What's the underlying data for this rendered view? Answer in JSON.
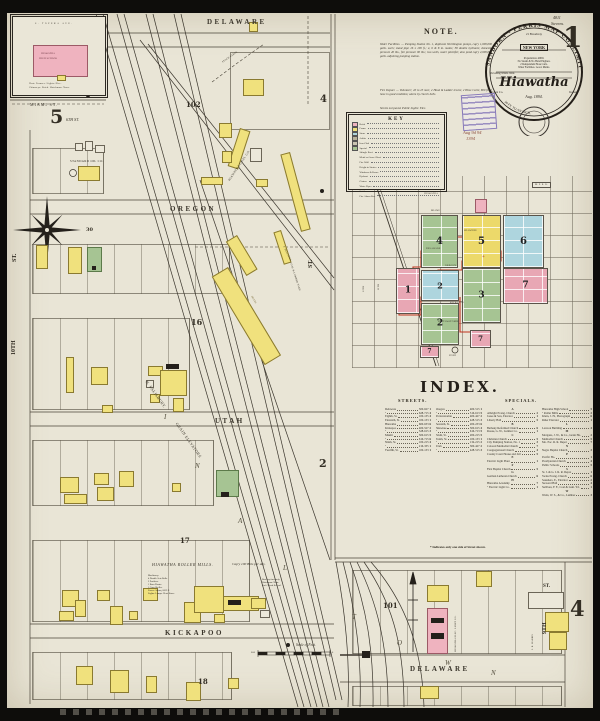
{
  "colors": {
    "paper": "#e9e5d6",
    "yellow": "#f0e17d",
    "pink": "#efb3bf",
    "green": "#a6c493",
    "blue": "#aed5de",
    "red_line": "#c0321e",
    "ink": "#2b2721"
  },
  "page": {
    "sheet_number": "1",
    "plate_ref": "4811",
    "plate_name": "Stevens."
  },
  "title_circle": {
    "rim_top": "SANBORN - PERRIS MAP CO. LIMITED",
    "address": "21 Broadway",
    "city": "NEW YORK",
    "population": "Population 4000.",
    "engines": "No Steam & No Hand Engines.",
    "hose": "2 Independent Hose Carts.",
    "water": "Water Facilities. Good. Mains.",
    "winds": "Prevailing Winds. West.",
    "town": "Hiawatha",
    "county": "Brown Co.",
    "state": "Kansas",
    "date": "Aug. 1894.",
    "rim_bottom": "50 FT. TO AN INCH."
  },
  "stamps": {
    "received_line1": "Aug 9d 94",
    "received_line2": "1394"
  },
  "note": {
    "title": "NOTE.",
    "water": "Water Facilities. — Pumping Station No. 1, duplicate Worthington pumps, cap'y 1,000,000 galls. each; stand pipe 16 x 100 ft.; 4, 6 & 8 in. mains; 38 double hydrants; domestic pressure 40 lbs., fire pressure 90 lbs.; two wells, water plentiful; also pond cap'y 2,000,000 galls. adjoining pumping station.",
    "fire": "Fire Depart. — Volunteer; 20 to 25 men; 2 Hook & Ladder trucks; 2 Hose Carts; 800 ft. of hose in good condition; alarm by church bells.",
    "footer": "Streets not paved. Public Lights: Elec."
  },
  "key": {
    "title": "KEY",
    "rows": [
      {
        "c": "#efb3bf",
        "n": "Brick"
      },
      {
        "c": "#f0e17d",
        "n": "Frame"
      },
      {
        "c": "#aed5de",
        "n": "Stone"
      },
      {
        "c": "#b9b29a",
        "n": "Adobe"
      },
      {
        "c": "#c9c4b2",
        "n": "Iron Clad"
      },
      {
        "c": "#a6c493",
        "n": "Special"
      },
      {
        "n": "Shingle Roof"
      },
      {
        "n": "Metal or Gravel Roof"
      },
      {
        "n": "Fire Wall"
      },
      {
        "n": "Height in Stories"
      },
      {
        "n": "Windows & Doors"
      },
      {
        "n": "Hydrant"
      },
      {
        "n": "Cistern"
      },
      {
        "n": "Water Pipes"
      },
      {
        "n": "Stable"
      },
      {
        "n": "Fire Alarm Box"
      }
    ]
  },
  "index_map": {
    "streets": {
      "hiawatha": "HIAWATHA",
      "miami": "MIAMI",
      "shawnee": "SHAWNEE",
      "delaware": "DELAWARE",
      "oregon": "OREGON",
      "kickapoo": "KICKAPOO",
      "pottawatomie": "POTTAWATOMIE",
      "eleventh": "11TH",
      "twelfth": "12TH"
    },
    "rr_box": "M. P. R. R.",
    "pond": "POND",
    "cross": "+",
    "groups": {
      "g4": "4",
      "g5": "5",
      "g6": "6",
      "g1": "1",
      "g2": "2",
      "g3": "3",
      "g2b": "2",
      "g7": "7",
      "g7b": "7",
      "g7c": "7"
    }
  },
  "index": {
    "title": "INDEX.",
    "streets_header": "STREETS.",
    "specials_header": "SPECIALS.",
    "streets_col1": [
      {
        "n": "Delaware",
        "r": "500-627",
        "s": "1"
      },
      {
        "n": "  \"",
        "r": "628-715",
        "s": "4"
      },
      {
        "n": "Eighth, St.",
        "r": "100-135",
        "s": "4"
      },
      {
        "n": "Eleventh, St.",
        "r": "100-133",
        "s": "1"
      },
      {
        "n": "Hiawatha",
        "r": "600-633",
        "s": "6"
      },
      {
        "n": "Kickapoo",
        "r": "400-527",
        "s": "2"
      },
      {
        "n": "  \"",
        "r": "528-615",
        "s": "3"
      },
      {
        "n": "Miami",
        "r": "500-615",
        "s": "5"
      },
      {
        "n": "  \"",
        "r": "616-715",
        "s": "6"
      },
      {
        "n": "Ninth, St.",
        "r": "100-215",
        "s": "4"
      },
      {
        "n": "  \"",
        "r": "216-335",
        "s": "1"
      },
      {
        "n": "Twelfth, St.",
        "r": "100-133",
        "s": "1"
      }
    ],
    "streets_col2": [
      {
        "n": "Oregon",
        "r": "400-515",
        "s": "1"
      },
      {
        "n": "  \"",
        "r": "516-613",
        "s": "5"
      },
      {
        "n": "Pottawatomie",
        "r": "400-427",
        "s": "2"
      },
      {
        "n": "  \"",
        "r": "428-515",
        "s": "3"
      },
      {
        "n": "Seventh, St.",
        "r": "200-233",
        "s": "6"
      },
      {
        "n": "Shawnee",
        "r": "500-615",
        "s": "4"
      },
      {
        "n": "  \"",
        "r": "616-713",
        "s": "5"
      },
      {
        "n": "Sixth, St.",
        "r": "200-215",
        "s": "5"
      },
      {
        "n": "Tenth, St.",
        "r": "100-133",
        "s": "1"
      },
      {
        "n": "  \"",
        "r": "134-215",
        "s": "2"
      },
      {
        "n": "Utah",
        "r": "300-427",
        "s": "2"
      },
      {
        "n": "  \"",
        "r": "428-515",
        "s": "3"
      }
    ],
    "specials_col1": [
      {
        "_c": "hdr",
        "n": "A"
      },
      {
        "n": "Albright Evang. Church",
        "s": "2"
      },
      {
        "n": "Jones & Son, Elevator",
        "s": "1"
      },
      {
        "n": "Liberty Hall",
        "s": "5"
      },
      {
        "_c": "hdr",
        "n": "B"
      },
      {
        "n": "Bethany Reformed Church",
        "s": "6"
      },
      {
        "n": "Rouse, G. W., Lumber Co.",
        "s": "1"
      },
      {
        "_c": "hdr",
        "n": "C"
      },
      {
        "n": "Christian Church",
        "s": "5"
      },
      {
        "n": "City Pumping Station, No. 1",
        "s": "3"
      },
      {
        "n": "Colored Methodist Church",
        "s": "7"
      },
      {
        "n": "Congregational Church",
        "s": "4"
      },
      {
        "n": "County Court House and Jail",
        "s": "5"
      },
      {
        "_c": "hdr",
        "n": "E"
      },
      {
        "n": "Electric Light Plant",
        "s": "1"
      },
      {
        "_c": "hdr",
        "n": "F"
      },
      {
        "n": "First Baptist Church",
        "s": "5"
      },
      {
        "_c": "hdr",
        "n": "G"
      },
      {
        "n": "German Lutheran Church",
        "s": "6"
      },
      {
        "_c": "hdr",
        "n": "H"
      },
      {
        "n": "Hiawatha Academy",
        "s": "7"
      },
      {
        "n": "  \"  Electric Light Co.",
        "s": "1"
      }
    ],
    "specials_col2": [
      {
        "n": "Hiawatha High School",
        "s": "5"
      },
      {
        "n": "  \"  Roller Mills",
        "s": "2"
      },
      {
        "n": "Klein, J. H., Photograph",
        "s": "6"
      },
      {
        "n": "Rider Elevator",
        "s": "1"
      },
      {
        "_c": "hdr",
        "n": "L"
      },
      {
        "n": "Lawson Building",
        "s": "4"
      },
      {
        "_c": "hdr",
        "n": "M"
      },
      {
        "n": "Morgans, J. W., & Co., Grain Ho.",
        "s": "2"
      },
      {
        "n": "Methodist Church",
        "s": "5"
      },
      {
        "n": "Mo. Pac. R. R. Depot",
        "s": "7"
      },
      {
        "_c": "hdr",
        "n": "N"
      },
      {
        "n": "Negro Baptist Church",
        "s": "3"
      },
      {
        "_c": "hdr",
        "n": "P"
      },
      {
        "n": "Pacific Ho.",
        "s": "1"
      },
      {
        "n": "Presbyterian Church",
        "s": "4"
      },
      {
        "n": "Public Schools",
        "s": "5"
      },
      {
        "_c": "hdr",
        "n": "S"
      },
      {
        "n": "St. J. & G. I. R. R. Depot",
        "s": "1"
      },
      {
        "n": "Swiss Evang. Church",
        "s": "6"
      },
      {
        "n": "Saunders, E., Elevator",
        "s": "2"
      },
      {
        "n": "Steward Hall",
        "s": "4"
      },
      {
        "n": "Sullivan, F. F., Coal & Lum. Yd.",
        "s": "1"
      },
      {
        "_c": "hdr",
        "n": "W"
      },
      {
        "n": "Watts, W. S., & Co., Lumber",
        "s": "3"
      }
    ],
    "footnote": "* Indicates only one side of Street shown."
  },
  "map": {
    "streets": {
      "delaware_top": "DELAWARE",
      "oregon": "OREGON",
      "utah": "UTAH",
      "kickapoo": "KICKAPOO",
      "st_left": "ST.",
      "tenth_left": "10TH",
      "st_mid": "ST."
    },
    "blocks": {
      "b102": "102",
      "b30": "30",
      "b16": "16",
      "b17": "17",
      "b18": "18",
      "m4_top": "4",
      "m2_mid": "2"
    },
    "businesses": {
      "standard_oil": "STANDARD OIL CO.",
      "coal": "HIAWATHA COAL CO.",
      "salisbury": "N. SALISBURY.",
      "grain": "GRAIN ELEVATORS",
      "sullivan": "F. SULLIVAN",
      "coalyard": "COAL & LUMBER YARD",
      "hotel": "HOTEL",
      "mills": "HIAWATHA ROLLER MILLS.",
      "mills_cap": "Cap'y 100 Bbls per day.",
      "stockyards": "STOCK YARDS"
    },
    "mills_lines": [
      {
        "n": "Machinery:"
      },
      {
        "n": "4 Double Sets Rolls."
      },
      {
        "n": "2 Purifiers."
      },
      {
        "n": "1 Bran Duster."
      },
      {
        "n": "1 Corn Sheller."
      },
      {
        "n": "Power: Steam, 60 H.P."
      },
      {
        "n": "Lights: Lamps. Heat: Stove."
      }
    ],
    "mills_notes": [
      {
        "n": "Run day time only."
      },
      {
        "n": "Watchman: None."
      },
      {
        "n": "Fuel: Wood & Coal."
      }
    ],
    "track_letters": [
      "I",
      "N",
      "A",
      "L"
    ],
    "scale": {
      "label": "Scale of Feet.",
      "left": "600",
      "right": "0"
    }
  },
  "inset": {
    "avenue": "S. TOPEKA AVE.",
    "school1": "HIAWATHA",
    "school2": "HIGH SCHOOL",
    "d1": "Heat: Furnace. Lights: Elec.",
    "d2": "Chimneys: Brick. Watchman: None.",
    "miami": "MIAMI ST.",
    "number": "5",
    "sixth": "6TH ST."
  },
  "bottom": {
    "block": "101",
    "delaware": "DELAWARE",
    "elec": "HIAWATHA ELEC. LIGHT CO.",
    "harris": "J. R. HARRIS",
    "st": "ST.",
    "ninth": "9TH",
    "margin": "4",
    "letters": [
      "T",
      "O",
      "W",
      "N"
    ]
  }
}
